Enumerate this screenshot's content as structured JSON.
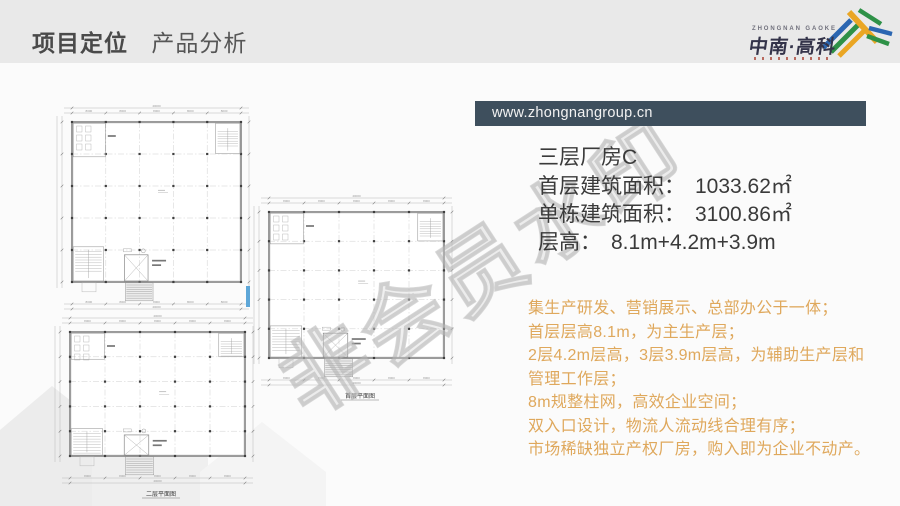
{
  "header": {
    "title_primary": "项目定位",
    "title_secondary": "产品分析",
    "logo": {
      "name_en": "ZHONGNAN GAOKE",
      "name_cn": "中南·高科"
    }
  },
  "banner": {
    "url": "www.zhongnangroup.cn"
  },
  "product": {
    "title": "三层厂房C",
    "specs": [
      {
        "label": "首层建筑面积：",
        "value": "1033.62㎡"
      },
      {
        "label": "单栋建筑面积：",
        "value": "3100.86㎡"
      },
      {
        "label": "层高：",
        "value": "8.1m+4.2m+3.9m"
      }
    ]
  },
  "features": {
    "lines": [
      "集生产研发、营销展示、总部办公于一体；",
      "首层层高8.1m，为主生产层；",
      "2层4.2m层高，3层3.9m层高，为辅助生产层和",
      "管理工作层；",
      "8m规整柱网，高效企业空间；",
      "双入口设计，物流人流动线合理有序；",
      "市场稀缺独立产权厂房，购入即为企业不动产。"
    ]
  },
  "floor_plans": {
    "dim_bay": "8000",
    "dim_total": "40000",
    "plans": [
      {
        "caption": ""
      },
      {
        "caption": "首层平面图"
      },
      {
        "caption": "二层平面图"
      }
    ]
  },
  "watermark": {
    "text": "非会员水印"
  },
  "colors": {
    "banner_bg": "#3e4f5d",
    "accent_gold": "#dfa85c",
    "header_bg": "#e9e9e9",
    "text_dark": "#3a3a3a",
    "logo_blue": "#2b66b1",
    "logo_green": "#2e9147",
    "logo_gold": "#eaa624"
  }
}
